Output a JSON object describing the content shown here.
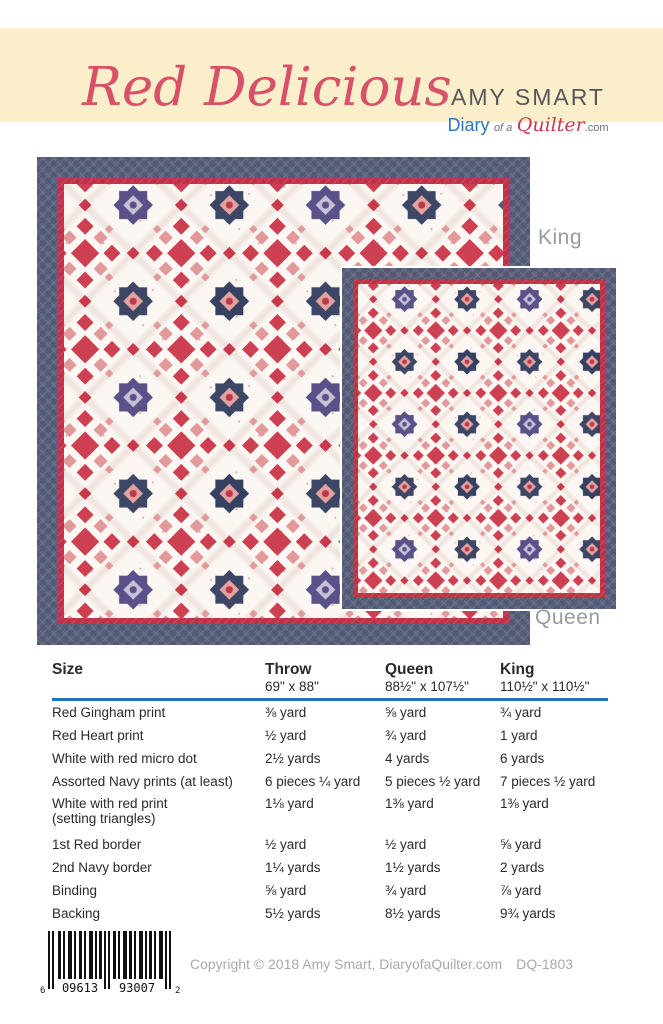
{
  "header": {
    "title": "Red Delicious",
    "brand_name": "AMY SMART",
    "brand_diary": "Diary",
    "brand_ofa": "of a",
    "brand_quilter": "Quilter",
    "brand_com": ".com"
  },
  "quilts": {
    "king_label": "King",
    "queen_label": "Queen"
  },
  "table": {
    "size_header": "Size",
    "columns": [
      {
        "name": "Throw",
        "dims": "69\" x 88\""
      },
      {
        "name": "Queen",
        "dims": "88½\" x 107½\""
      },
      {
        "name": "King",
        "dims": "110½\" x 110½\""
      }
    ],
    "rows": [
      {
        "label": "Red Gingham print",
        "throw": "⅜ yard",
        "queen": "⅝ yard",
        "king": "¾ yard"
      },
      {
        "label": "Red Heart print",
        "throw": "½ yard",
        "queen": "¾ yard",
        "king": "1 yard"
      },
      {
        "label": "White with red micro dot",
        "throw": "2½ yards",
        "queen": "4 yards",
        "king": "6 yards"
      },
      {
        "label": "Assorted Navy prints (at least)",
        "throw": "6 pieces ¼ yard",
        "queen": "5 pieces ½ yard",
        "king": "7 pieces ½ yard"
      },
      {
        "label": "White with red print",
        "sublabel": "(setting triangles)",
        "throw": "1⅛ yard",
        "queen": "1⅜ yard",
        "king": "1⅜ yard"
      },
      {
        "label": "1st Red border",
        "throw": "½ yard",
        "queen": "½ yard",
        "king": "⅝ yard"
      },
      {
        "label": "2nd Navy border",
        "throw": "1¼ yards",
        "queen": "1½ yards",
        "king": "2 yards"
      },
      {
        "label": "Binding",
        "throw": "⅝ yard",
        "queen": "¾ yard",
        "king": "⅞ yard"
      },
      {
        "label": "Backing",
        "throw": "5½ yards",
        "queen": "8½ yards",
        "king": "9¾  yards"
      }
    ]
  },
  "footer": {
    "copyright": "Copyright © 2018 Amy Smart, DiaryofaQuilter.com",
    "code": "DQ-1803",
    "barcode": {
      "lead": "6",
      "left": "09613",
      "right": "93007",
      "trail": "2"
    }
  },
  "colors": {
    "cream_band": "#fbeeca",
    "title_pink": "#d85168",
    "rule_blue": "#1c75bc",
    "quilt_navy_border": "#59617a",
    "quilt_red_border": "#c03449",
    "star_navy": "#3d4665",
    "chain_red": "#cd4052",
    "label_gray": "#9a9a9a"
  }
}
